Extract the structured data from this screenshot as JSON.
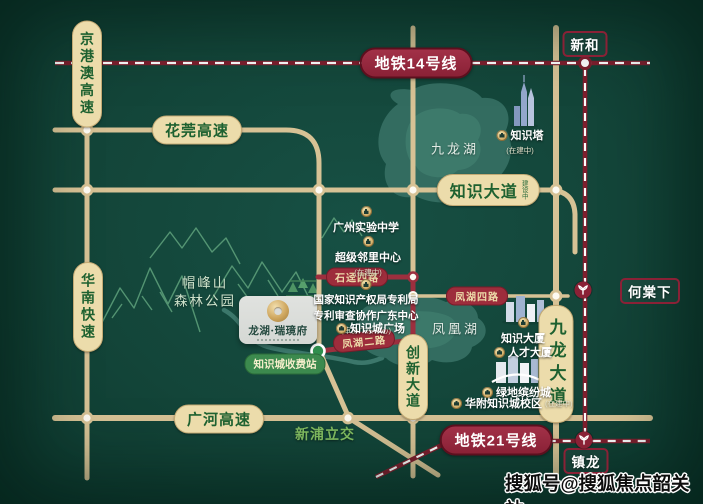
{
  "labels": {
    "highways": {
      "jinggangao": "京港澳高速",
      "huawan": "花莞高速",
      "huanan": "华南快速",
      "guanghe": "广河高速"
    },
    "avenues": {
      "zhishi": "知识大道",
      "zhishi_note": "建设中",
      "chuangxin": "创新大道",
      "jiulong": "九龙大道"
    },
    "minor_roads": {
      "shijing": "石迳四路",
      "fenghu4": "凤湖四路",
      "fenghu2": "凤湖二路"
    },
    "metro": {
      "line14": "地铁14号线",
      "line21": "地铁21号线"
    },
    "stations": {
      "xinhe": "新和",
      "hetangxia": "何棠下",
      "zhenlong": "镇龙"
    },
    "toll_station": "知识城收费站",
    "interchange": "新浦立交",
    "lakes": {
      "jiulonghu": "九龙湖",
      "fenghuanghu": "凤凰湖"
    },
    "park": {
      "line1": "帽峰山",
      "line2": "森林公园"
    }
  },
  "pois": {
    "school": {
      "name": "广州实验中学"
    },
    "neighborhood": {
      "name": "超级邻里中心",
      "note": "(在建中)"
    },
    "patent": {
      "line1": "国家知识产权局专利局",
      "line2": "专利审查协作广东中心",
      "note": "(审协广东中心)"
    },
    "plaza": {
      "name": "知识城广场"
    },
    "tower": {
      "name": "知识塔",
      "note": "(在建中)"
    },
    "zhishi_mansion": {
      "name": "知识大厦"
    },
    "talent_mansion": {
      "name": "人才大厦"
    },
    "greenland": {
      "name": "绿地缤纷城"
    },
    "affiliated_school": {
      "name": "华附知识城校区",
      "note": "(在建中)"
    }
  },
  "project": {
    "name": "龙湖·瑞璄府"
  },
  "watermark": "搜狐号@搜狐焦点韶关站",
  "colors": {
    "background": "#134539",
    "road": "#d7c295",
    "minor_road": "#9c2f3e",
    "metro": "#8a2136",
    "pill_bg": "#ecdcab",
    "pill_text": "#1e6130",
    "lake": "#2f6a5f",
    "toll_green": "#3c8a4e"
  }
}
